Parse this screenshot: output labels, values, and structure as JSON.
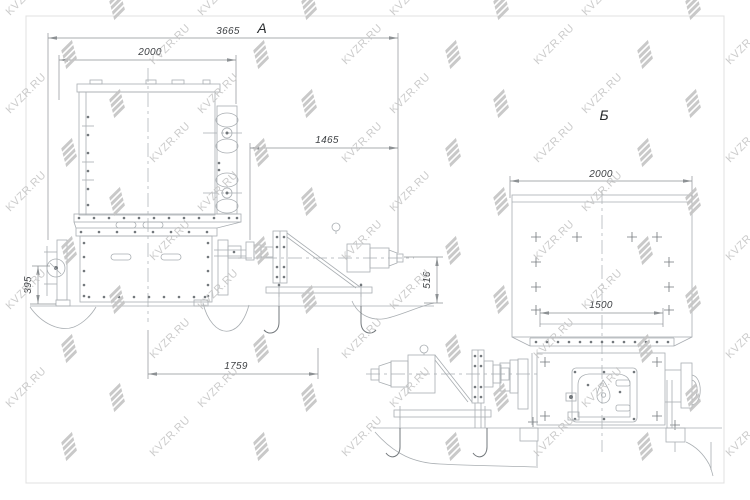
{
  "drawing": {
    "views": {
      "a": {
        "label": "А",
        "dimensions": {
          "overall_width": "3665",
          "box_width": "2000",
          "motor_offset": "1465",
          "support_height": "395",
          "frame_length": "1759",
          "motor_height": "516"
        }
      },
      "b": {
        "label": "Б",
        "dimensions": {
          "box_width": "2000",
          "inner_width": "1500"
        }
      }
    }
  },
  "watermark": {
    "text": "KVZR.RU"
  },
  "colors": {
    "background": "#ffffff",
    "border": "#e0e0e0",
    "line": "#a9aeb2",
    "line_dark": "#73787c",
    "dim_line": "#8d9194",
    "dim_text": "#3f4245",
    "label_text": "#26292b",
    "watermark": "#c3c3c3"
  }
}
